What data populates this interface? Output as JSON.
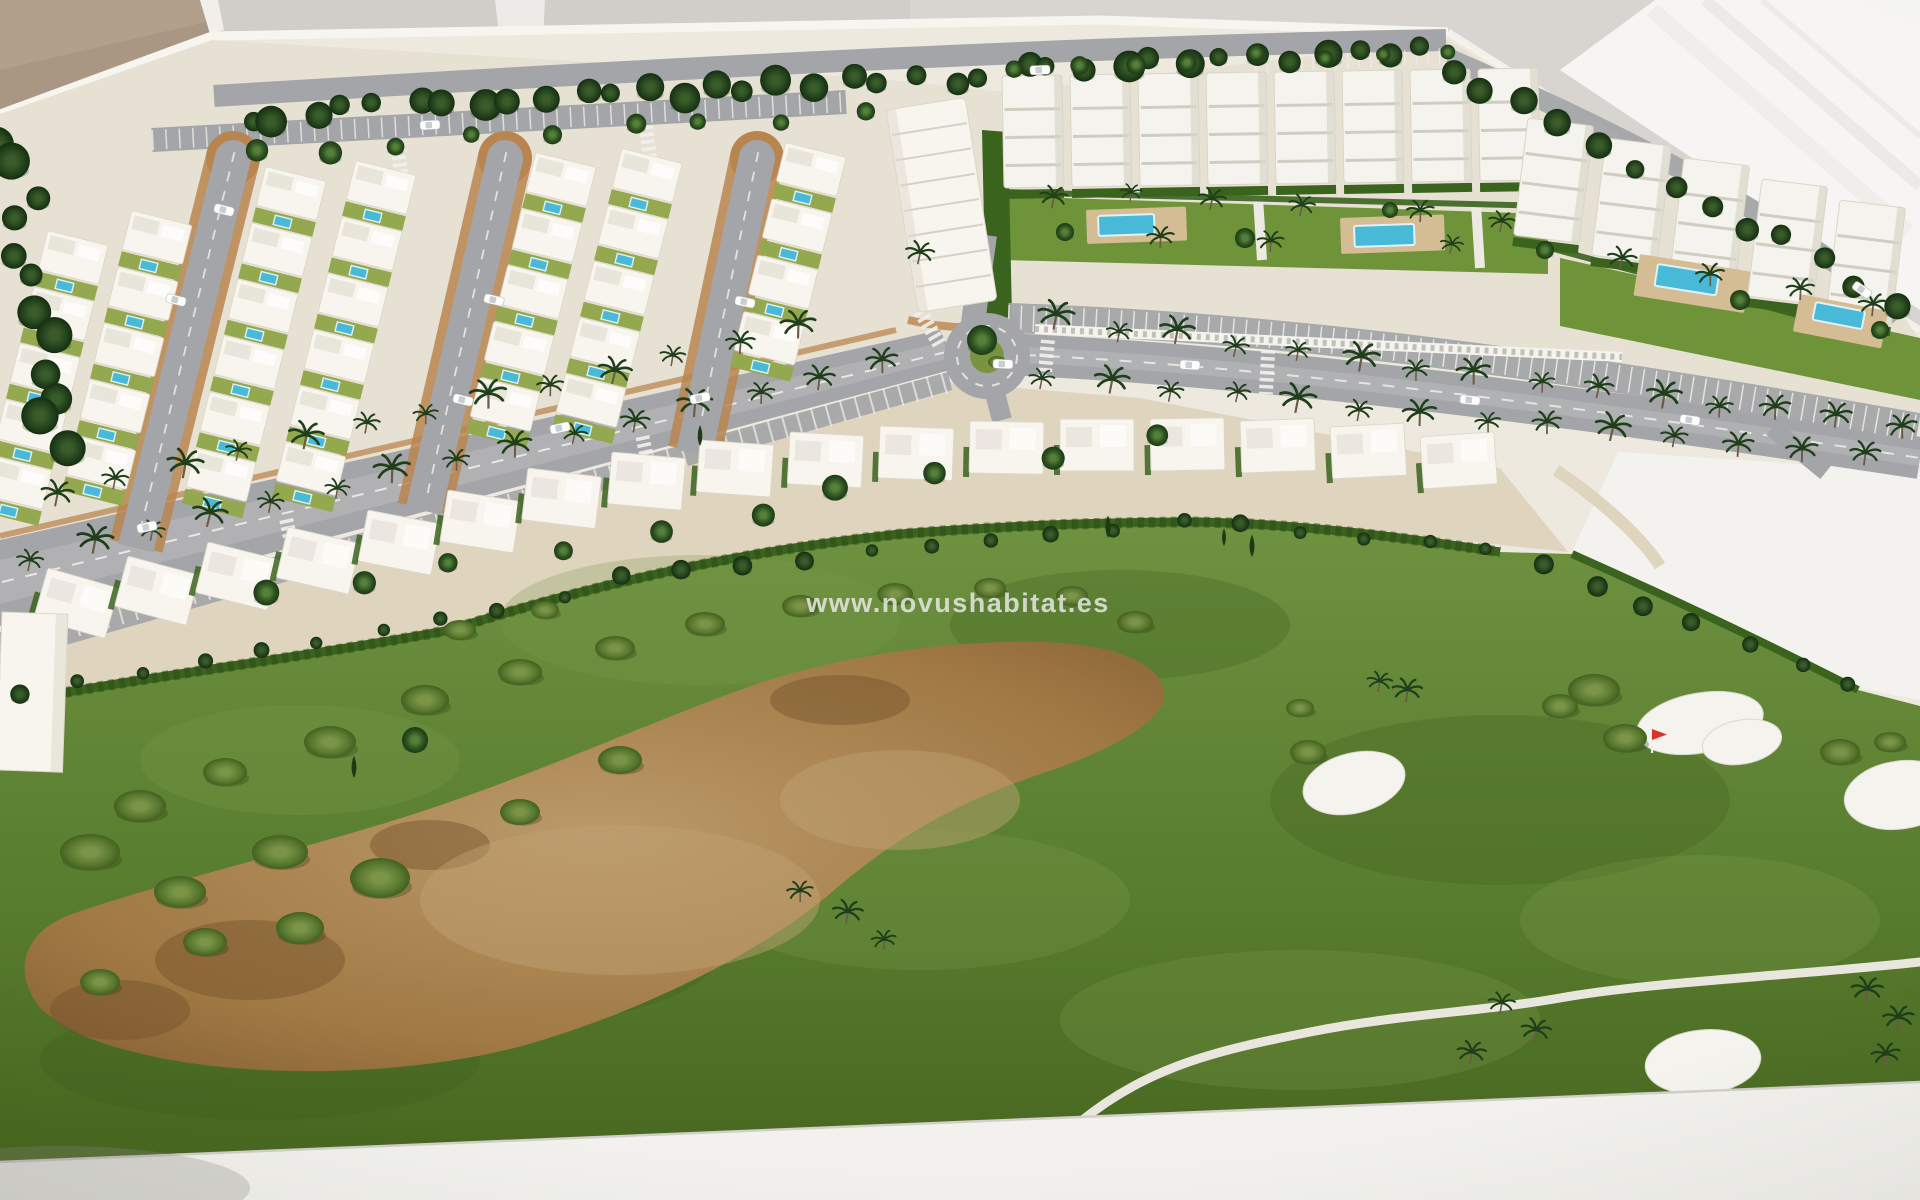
{
  "watermark": {
    "text": "www.novushabitat.es"
  },
  "palette": {
    "wall": "#d8d5d1",
    "wall_shade": "#c9c6c1",
    "beige": "#b2a08c",
    "beige_dark": "#a3907c",
    "glare": "#f8f7f5",
    "glare_streak": "#e8e6e2",
    "board": "#eee9df",
    "board_edge": "#f7f5ef",
    "ground": "#e7e1d3",
    "ground_tan": "#dfd5bf",
    "rim_tan": "#b9854f",
    "road": "#a4a5a8",
    "road_light": "#c2c2c4",
    "marking": "#f2f1ed",
    "villa": "#f7f5ee",
    "villa_shade": "#dcd7ca",
    "yard": "#93a84f",
    "pool": "#49b9d8",
    "pool_rim": "#dff2f7",
    "deck": "#d4bd94",
    "hedge": "#3a631e",
    "hedge_dark": "#2b4b15",
    "grass_light": "#6e9240",
    "grass_dark": "#4a6a22",
    "waste": "#a8824e",
    "waste_light": "#c2a173",
    "waste_dark": "#74512a",
    "bush": "#66823a",
    "tree": "#2c501f",
    "tree_light": "#4a7232",
    "palm": "#1e3f1a",
    "trunk": "#6b5a44",
    "bunker": "#f4f3ee",
    "path": "#e9e6dd",
    "fence": "#f4f3ee",
    "fence_slot": "#97938a",
    "car": "#fdfdfc",
    "base": "#f2f1ed",
    "base_shadow": "#8b8780",
    "flag_red": "#d9342b",
    "block": "#f5f3ed",
    "block_shade": "#d9d5c8",
    "block_line": "#c7c3b7"
  },
  "scene": {
    "tree_rows": [
      {
        "x1": 245,
        "y1": 118,
        "x2": 1425,
        "y2": 48,
        "n": 36,
        "rmin": 9,
        "rmax": 16,
        "g": "gTd",
        "jx": 10,
        "jy": 8,
        "seed": 1
      },
      {
        "x1": 255,
        "y1": 152,
        "x2": 860,
        "y2": 112,
        "n": 9,
        "rmin": 8,
        "rmax": 12,
        "g": "gT",
        "jx": 12,
        "jy": 6,
        "seed": 2
      },
      {
        "x1": 1448,
        "y1": 70,
        "x2": 1898,
        "y2": 300,
        "n": 13,
        "rmin": 9,
        "rmax": 14,
        "g": "gTd",
        "jx": 8,
        "jy": 8,
        "seed": 3
      },
      {
        "x1": 14,
        "y1": 138,
        "x2": 56,
        "y2": 452,
        "n": 12,
        "rmin": 11,
        "rmax": 19,
        "g": "gTd",
        "jx": 18,
        "jy": 8,
        "seed": 4
      },
      {
        "x1": 1010,
        "y1": 66,
        "x2": 1440,
        "y2": 50,
        "n": 8,
        "rmin": 7,
        "rmax": 10,
        "g": "gT",
        "jx": 10,
        "jy": 4,
        "seed": 5
      },
      {
        "x1": 255,
        "y1": 598,
        "x2": 1145,
        "y2": 440,
        "n": 10,
        "rmin": 9,
        "rmax": 13,
        "g": "gT",
        "jx": 14,
        "jy": 6,
        "seed": 6
      }
    ],
    "hedge_dot_rows": [
      {
        "x1": 20,
        "y1": 694,
        "x2": 560,
        "y2": 598,
        "n": 10,
        "rmin": 6,
        "rmax": 10,
        "g": "gTd",
        "jx": 6,
        "jy": 3,
        "seed": 7
      },
      {
        "x1": 620,
        "y1": 578,
        "x2": 1180,
        "y2": 522,
        "n": 10,
        "rmin": 6,
        "rmax": 10,
        "g": "gTd",
        "jx": 6,
        "jy": 3,
        "seed": 8
      },
      {
        "x1": 1240,
        "y1": 524,
        "x2": 1490,
        "y2": 550,
        "n": 5,
        "rmin": 6,
        "rmax": 9,
        "g": "gTd",
        "jx": 5,
        "jy": 3,
        "seed": 9
      },
      {
        "x1": 1540,
        "y1": 566,
        "x2": 1850,
        "y2": 686,
        "n": 7,
        "rmin": 7,
        "rmax": 11,
        "g": "gTd",
        "jx": 6,
        "jy": 4,
        "seed": 10
      }
    ],
    "palm_rows": [
      {
        "x1": 55,
        "y1": 505,
        "x2": 800,
        "y2": 336,
        "n": 13,
        "seed": 11
      },
      {
        "x1": 30,
        "y1": 568,
        "x2": 880,
        "y2": 372,
        "n": 15,
        "seed": 12
      },
      {
        "x1": 1055,
        "y1": 330,
        "x2": 1900,
        "y2": 436,
        "n": 15,
        "seed": 13
      },
      {
        "x1": 1045,
        "y1": 384,
        "x2": 1860,
        "y2": 466,
        "n": 14,
        "seed": 14
      }
    ],
    "garden_palms": [
      [
        1052,
        206
      ],
      [
        1130,
        200
      ],
      [
        1210,
        208
      ],
      [
        1300,
        214
      ],
      [
        1420,
        220
      ],
      [
        1500,
        230
      ],
      [
        1620,
        268
      ],
      [
        1710,
        284
      ],
      [
        1800,
        298
      ],
      [
        1872,
        314
      ],
      [
        1160,
        246
      ],
      [
        1270,
        250
      ],
      [
        1450,
        252
      ],
      [
        918,
        262
      ]
    ],
    "green_palms": [
      [
        1378,
        690
      ],
      [
        1406,
        700
      ],
      [
        1500,
        1012
      ],
      [
        1534,
        1040
      ],
      [
        1470,
        1062
      ],
      [
        1866,
        1000
      ],
      [
        1898,
        1028
      ],
      [
        1886,
        1064
      ],
      [
        800,
        900
      ],
      [
        846,
        922
      ],
      [
        884,
        948
      ]
    ],
    "garden_trees": [
      [
        1065,
        232,
        9
      ],
      [
        1245,
        238,
        10
      ],
      [
        1390,
        210,
        8
      ],
      [
        1545,
        250,
        9
      ],
      [
        1740,
        300,
        10
      ],
      [
        1880,
        330,
        9
      ],
      [
        415,
        740,
        13
      ]
    ],
    "cypresses": [
      [
        1108,
        538
      ],
      [
        1224,
        546
      ],
      [
        1252,
        557
      ],
      [
        700,
        446
      ],
      [
        354,
        778
      ]
    ],
    "villa_columns": [
      {
        "x": 78,
        "y": 238,
        "n": 5
      },
      {
        "x": 162,
        "y": 218,
        "n": 5
      },
      {
        "x": 296,
        "y": 174,
        "n": 6
      },
      {
        "x": 386,
        "y": 168,
        "n": 6
      },
      {
        "x": 566,
        "y": 160,
        "n": 5
      },
      {
        "x": 652,
        "y": 156,
        "n": 5
      },
      {
        "x": 816,
        "y": 150,
        "n": 4
      }
    ],
    "villa_step": 58,
    "villa_rot": 14,
    "hairpins": [
      {
        "x": 233,
        "y": 158,
        "len": 400,
        "rot": 14
      },
      {
        "x": 505,
        "y": 158,
        "len": 360,
        "rot": 13
      },
      {
        "x": 757,
        "y": 158,
        "len": 300,
        "rot": 12
      }
    ],
    "townhouse": {
      "x": 886,
      "y": 110,
      "w": 80,
      "h": 205,
      "rot": -9
    },
    "left_slab": {
      "x": 2,
      "y": 612,
      "w": 66,
      "h": 158,
      "rot": 2
    },
    "mid_villas": [
      [
        48,
        568,
        16
      ],
      [
        128,
        556,
        15
      ],
      [
        208,
        542,
        14
      ],
      [
        288,
        527,
        13
      ],
      [
        368,
        510,
        11
      ],
      [
        448,
        490,
        9
      ],
      [
        528,
        468,
        7
      ],
      [
        612,
        452,
        5
      ],
      [
        700,
        440,
        4
      ],
      [
        790,
        432,
        3
      ],
      [
        880,
        426,
        2
      ],
      [
        970,
        421,
        1
      ],
      [
        1060,
        419,
        0
      ],
      [
        1150,
        419,
        -1
      ],
      [
        1240,
        421,
        -2
      ],
      [
        1330,
        427,
        -3
      ],
      [
        1420,
        437,
        -4
      ]
    ],
    "blocks_a": {
      "x0": 1002,
      "pitch": 68,
      "n": 8,
      "y": 76,
      "w": 60,
      "h": 112,
      "rot": -1
    },
    "blocks_b": [
      [
        1528,
        118
      ],
      [
        1606,
        138
      ],
      [
        1684,
        158
      ],
      [
        1762,
        179
      ],
      [
        1840,
        200
      ]
    ],
    "blocks_b_size": {
      "w": 66,
      "h": 118,
      "rot": 7
    },
    "apt_pools": [
      {
        "deck": [
          1086,
          210,
          100,
          34,
          -2
        ],
        "pool": [
          1098,
          216,
          56,
          20,
          -2
        ]
      },
      {
        "deck": [
          1340,
          218,
          104,
          36,
          -2
        ],
        "pool": [
          1354,
          226,
          60,
          21,
          -2
        ]
      },
      {
        "deck": [
          1640,
          254,
          112,
          42,
          9
        ],
        "pool": [
          1658,
          264,
          62,
          22,
          9
        ]
      },
      {
        "deck": [
          1800,
          294,
          90,
          38,
          11
        ],
        "pool": [
          1816,
          302,
          50,
          18,
          11
        ]
      }
    ],
    "bunkers": [
      [
        1354,
        783,
        52,
        30,
        -14
      ],
      [
        1700,
        723,
        64,
        30,
        -10
      ],
      [
        1742,
        742,
        40,
        22,
        -10
      ],
      [
        1900,
        795,
        56,
        34,
        -8
      ],
      [
        1703,
        1062,
        58,
        32,
        -6
      ]
    ],
    "flag": [
      1652,
      753
    ],
    "bushes": [
      [
        140,
        806,
        26,
        16
      ],
      [
        225,
        772,
        22,
        14
      ],
      [
        330,
        742,
        26,
        16
      ],
      [
        425,
        700,
        24,
        15
      ],
      [
        520,
        672,
        22,
        13
      ],
      [
        615,
        648,
        20,
        12
      ],
      [
        705,
        624,
        20,
        12
      ],
      [
        800,
        606,
        18,
        11
      ],
      [
        895,
        594,
        18,
        11
      ],
      [
        990,
        588,
        16,
        10
      ],
      [
        1072,
        596,
        16,
        10
      ],
      [
        1135,
        622,
        18,
        11
      ],
      [
        90,
        852,
        30,
        18
      ],
      [
        180,
        892,
        26,
        16
      ],
      [
        280,
        852,
        28,
        17
      ],
      [
        375,
        880,
        24,
        15
      ],
      [
        205,
        942,
        22,
        14
      ],
      [
        100,
        982,
        20,
        13
      ],
      [
        1594,
        690,
        26,
        16
      ],
      [
        1625,
        738,
        22,
        14
      ],
      [
        1560,
        706,
        18,
        12
      ],
      [
        1840,
        752,
        20,
        13
      ],
      [
        1890,
        742,
        16,
        10
      ],
      [
        1308,
        752,
        18,
        12
      ],
      [
        1300,
        708,
        14,
        9
      ],
      [
        460,
        630,
        16,
        10
      ],
      [
        545,
        610,
        14,
        9
      ],
      [
        380,
        878,
        30,
        20
      ],
      [
        300,
        928,
        24,
        16
      ],
      [
        620,
        760,
        22,
        14
      ],
      [
        520,
        812,
        20,
        13
      ]
    ],
    "grass_patches": [
      [
        300,
        760,
        160,
        55,
        "l"
      ],
      [
        700,
        620,
        200,
        65,
        "l"
      ],
      [
        1120,
        625,
        170,
        55,
        "d"
      ],
      [
        500,
        950,
        220,
        75,
        "d"
      ],
      [
        920,
        900,
        210,
        70,
        "l"
      ],
      [
        1500,
        800,
        230,
        85,
        "d"
      ],
      [
        1700,
        920,
        180,
        65,
        "l"
      ],
      [
        260,
        1060,
        220,
        60,
        "d"
      ],
      [
        1300,
        1020,
        240,
        70,
        "l"
      ]
    ],
    "waste_patches": [
      [
        250,
        960,
        95,
        40,
        "d"
      ],
      [
        120,
        1010,
        70,
        30,
        "d"
      ],
      [
        430,
        845,
        60,
        25,
        "d"
      ],
      [
        840,
        700,
        70,
        25,
        "d"
      ],
      [
        620,
        900,
        200,
        75,
        "l"
      ],
      [
        900,
        800,
        120,
        50,
        "l"
      ]
    ],
    "cars": [
      [
        147,
        527,
        -12
      ],
      [
        560,
        428,
        -12
      ],
      [
        700,
        398,
        -12
      ],
      [
        1003,
        364,
        2
      ],
      [
        1190,
        365,
        3
      ],
      [
        1470,
        400,
        6
      ],
      [
        1690,
        420,
        8
      ],
      [
        224,
        210,
        14
      ],
      [
        176,
        300,
        14
      ],
      [
        494,
        300,
        13
      ],
      [
        463,
        400,
        13
      ],
      [
        745,
        302,
        12
      ],
      [
        430,
        125,
        -3
      ],
      [
        1040,
        70,
        -2
      ],
      [
        1862,
        290,
        35
      ]
    ],
    "crosswalks": [
      [
        291,
        542,
        78,
        46
      ],
      [
        647,
        458,
        78,
        44
      ],
      [
        1046,
        362,
        95,
        44
      ],
      [
        1267,
        372,
        93,
        44
      ],
      [
        400,
        166,
        82,
        34
      ],
      [
        648,
        143,
        83,
        34
      ],
      [
        930,
        328,
        60,
        40
      ]
    ],
    "roundabout": {
      "cx": 987,
      "cy": 356,
      "r_ring": 30,
      "r_island": 17
    }
  }
}
